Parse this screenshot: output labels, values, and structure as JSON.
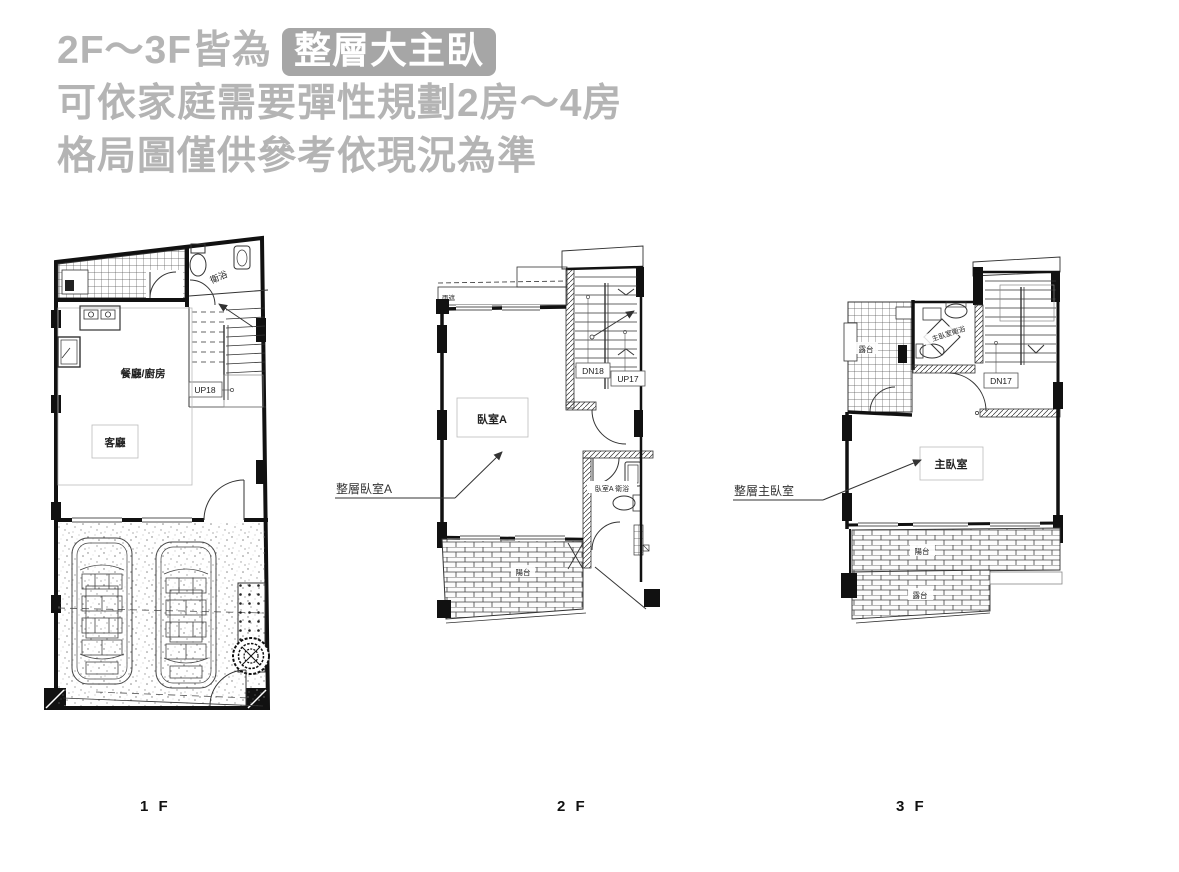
{
  "canvas": {
    "bg": "#ffffff",
    "ink": "#111111",
    "title_color": "#b4b4b4",
    "badge_bg": "#a6a6a6",
    "badge_fg": "#ffffff"
  },
  "header": {
    "line1_prefix": "2F～3F皆為",
    "line1_badge": "整層大主臥",
    "line2": "可依家庭需要彈性規劃2房～4房",
    "line3": "格局圖僅供參考依現況為準"
  },
  "floor1": {
    "caption": "1 F",
    "bathroom": "衛浴",
    "dining_kitchen": "餐廳/廚房",
    "living": "客廳",
    "stair_up": "UP18"
  },
  "floor2": {
    "caption": "2 F",
    "annotation": "整層臥室A",
    "canopy": "雨遮",
    "bedroom_a": "臥室A",
    "stair_down": "DN18",
    "stair_up": "UP17",
    "bathroom": "臥室A 衛浴",
    "balcony": "陽台"
  },
  "floor3": {
    "caption": "3 F",
    "annotation": "整層主臥室",
    "terrace_top": "露台",
    "bathroom": "主臥室衛浴",
    "stair_down": "DN17",
    "master_bedroom": "主臥室",
    "balcony": "陽台",
    "terrace_bottom": "露台"
  }
}
